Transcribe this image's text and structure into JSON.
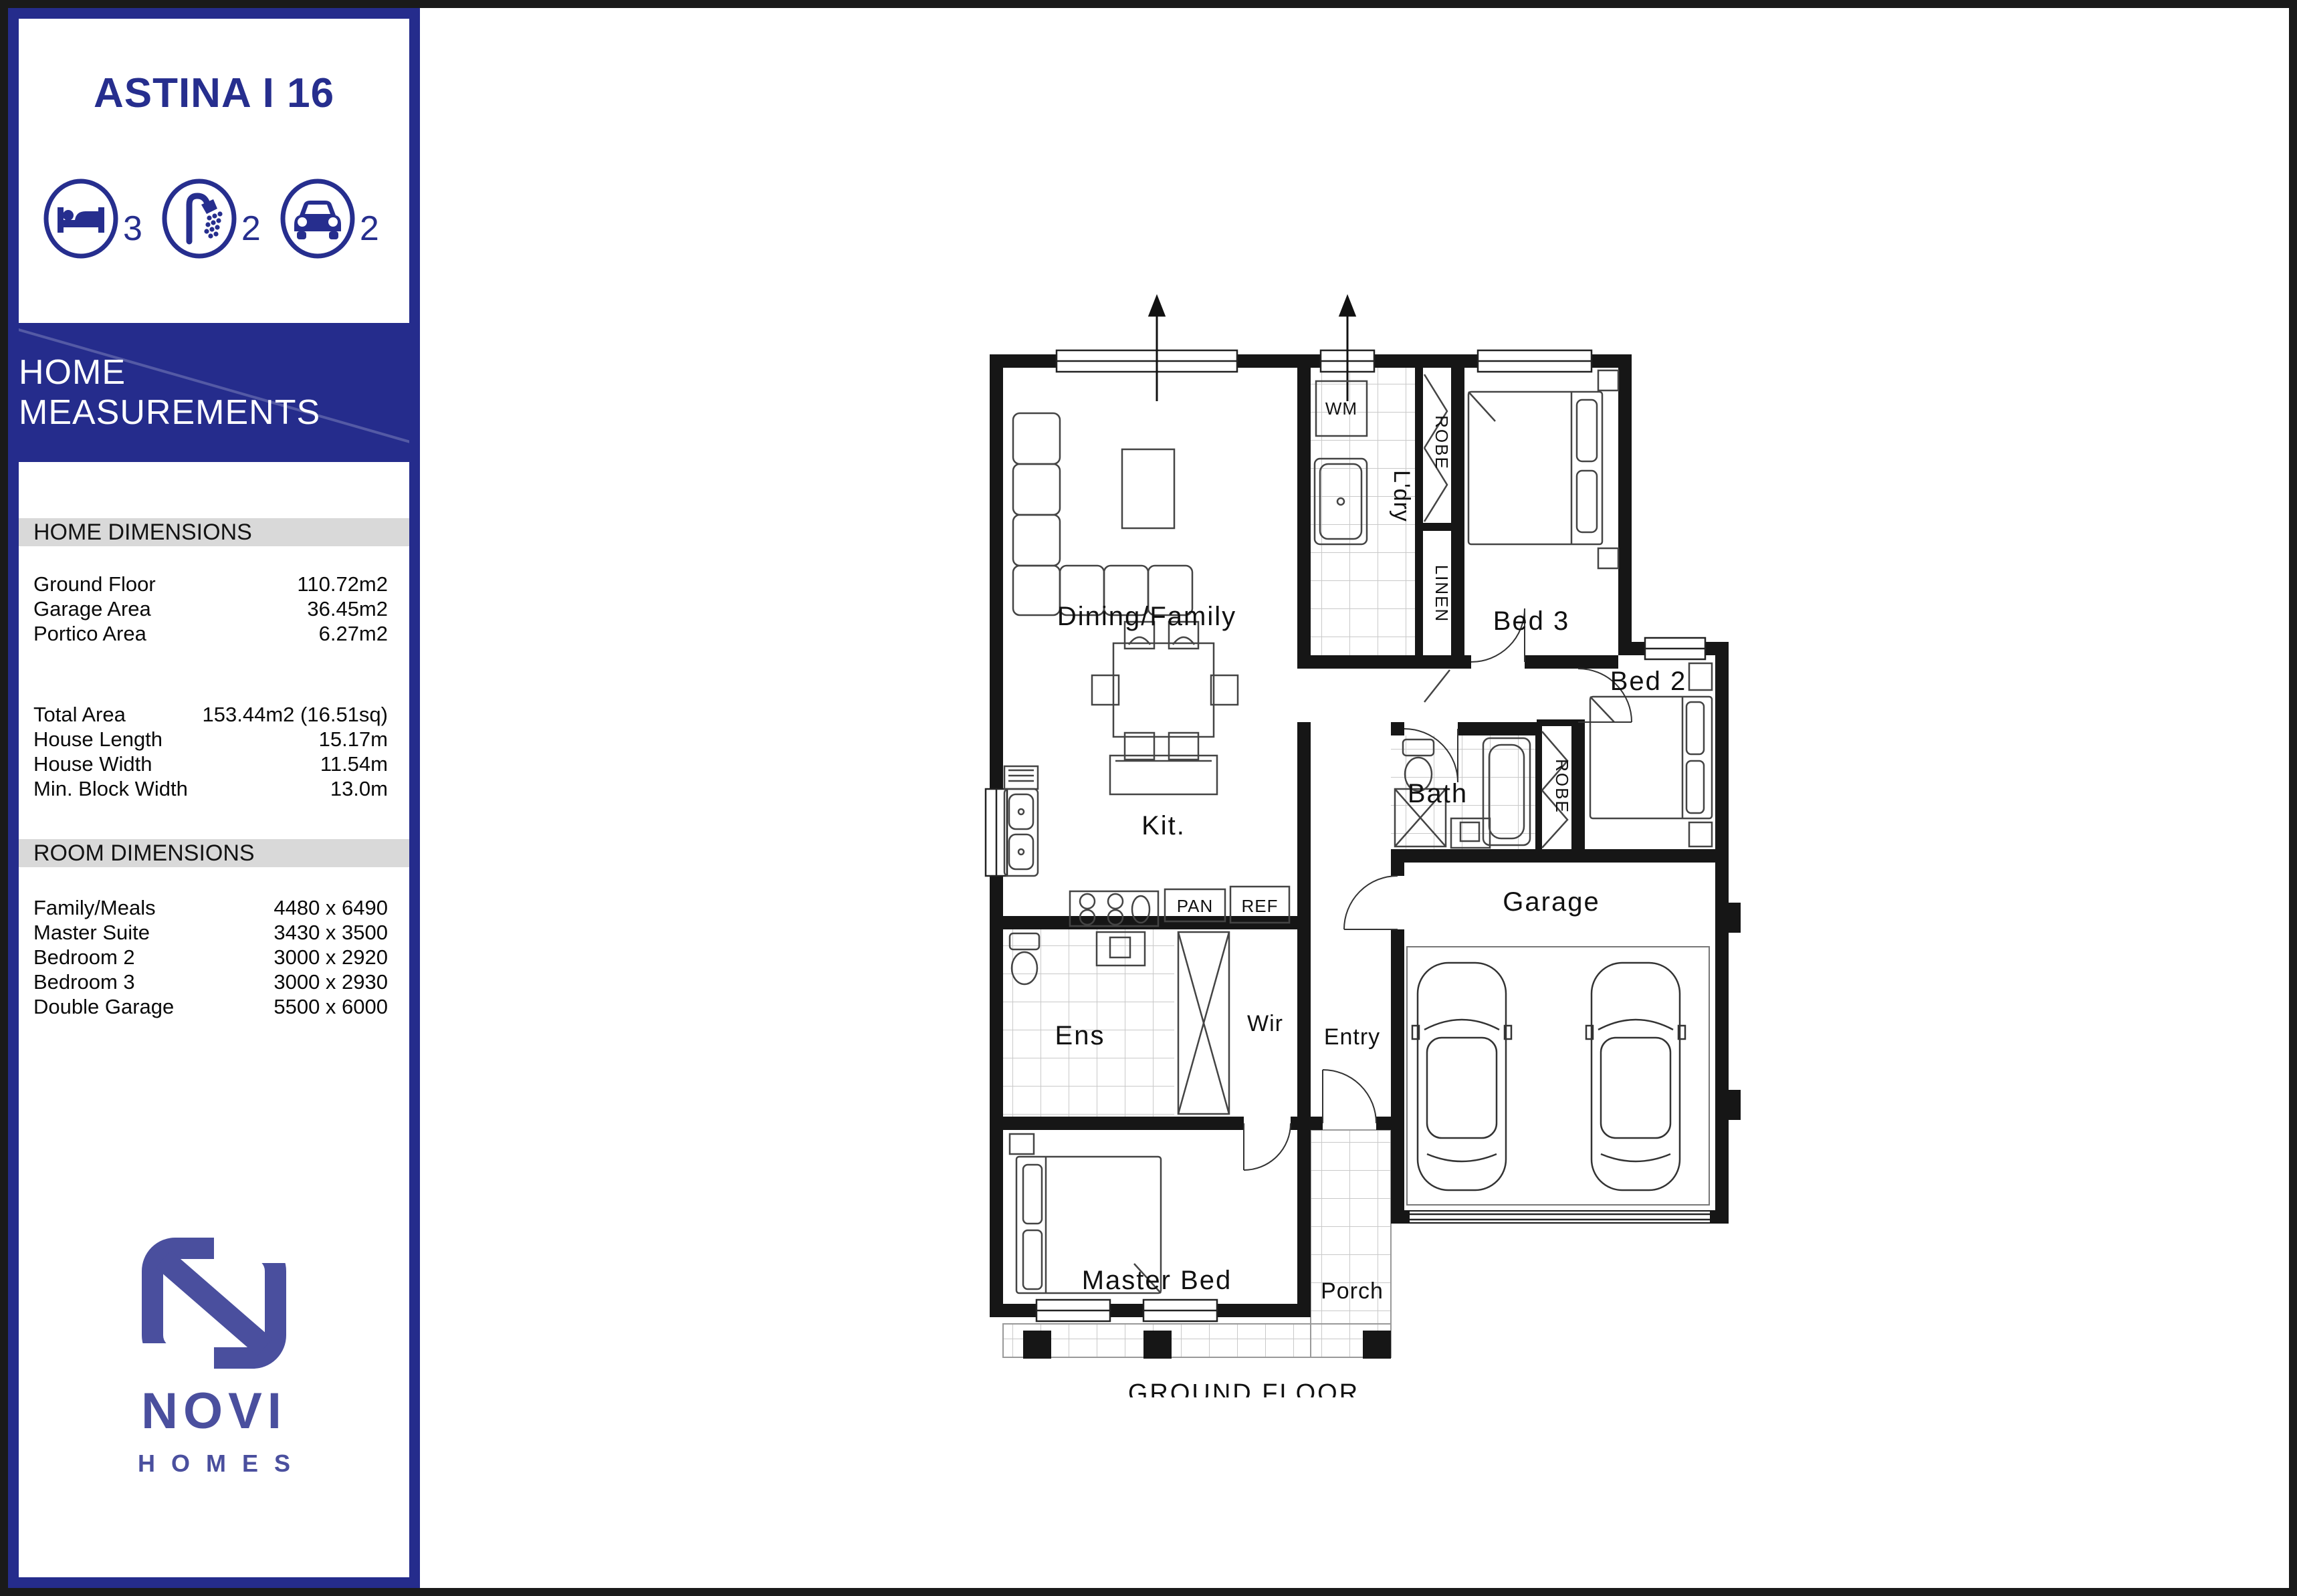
{
  "sidebar": {
    "title": "ASTINA I 16",
    "stats": [
      {
        "icon": "bed-icon",
        "count": "3"
      },
      {
        "icon": "shower-icon",
        "count": "2"
      },
      {
        "icon": "car-icon",
        "count": "2"
      }
    ],
    "banner": "HOME MEASUREMENTS",
    "home_dimensions": {
      "header": "HOME DIMENSIONS",
      "rows": [
        {
          "label": "Ground Floor",
          "value": "110.72m2"
        },
        {
          "label": "Garage Area",
          "value": "36.45m2"
        },
        {
          "label": "Portico Area",
          "value": "6.27m2"
        }
      ],
      "rows2": [
        {
          "label": "Total Area",
          "value": "153.44m2 (16.51sq)"
        },
        {
          "label": "House Length",
          "value": "15.17m"
        },
        {
          "label": "House Width",
          "value": "11.54m"
        },
        {
          "label": "Min. Block Width",
          "value": "13.0m"
        }
      ]
    },
    "room_dimensions": {
      "header": "ROOM DIMENSIONS",
      "rows": [
        {
          "label": "Family/Meals",
          "value": "4480 x 6490"
        },
        {
          "label": "Master Suite",
          "value": "3430 x 3500"
        },
        {
          "label": "Bedroom 2",
          "value": "3000 x 2920"
        },
        {
          "label": "Bedroom 3",
          "value": "3000 x 2930"
        },
        {
          "label": "Double Garage",
          "value": "5500 x 6000"
        }
      ]
    },
    "logo": {
      "name": "NOVI",
      "sub": "HOMES"
    }
  },
  "plan": {
    "labels": {
      "dining": "Dining/Family",
      "kit": "Kit.",
      "pan": "PAN",
      "ref": "REF",
      "wm": "WM",
      "ldry": "L'dry",
      "robe_bed3": "ROBE",
      "linen": "LINEN",
      "bed3": "Bed 3",
      "bed2": "Bed 2",
      "bath": "Bath",
      "robe_bed2": "ROBE",
      "garage": "Garage",
      "ens": "Ens",
      "wir": "Wir",
      "entry": "Entry",
      "master": "Master Bed",
      "porch": "Porch"
    },
    "caption": "GROUND FLOOR"
  },
  "colors": {
    "brand_blue": "#252c8c",
    "logo_blue": "#4a4f9e",
    "wall_black": "#161616",
    "tile_gray": "#c9c9c9",
    "strip_gray": "#d9d9d9"
  }
}
